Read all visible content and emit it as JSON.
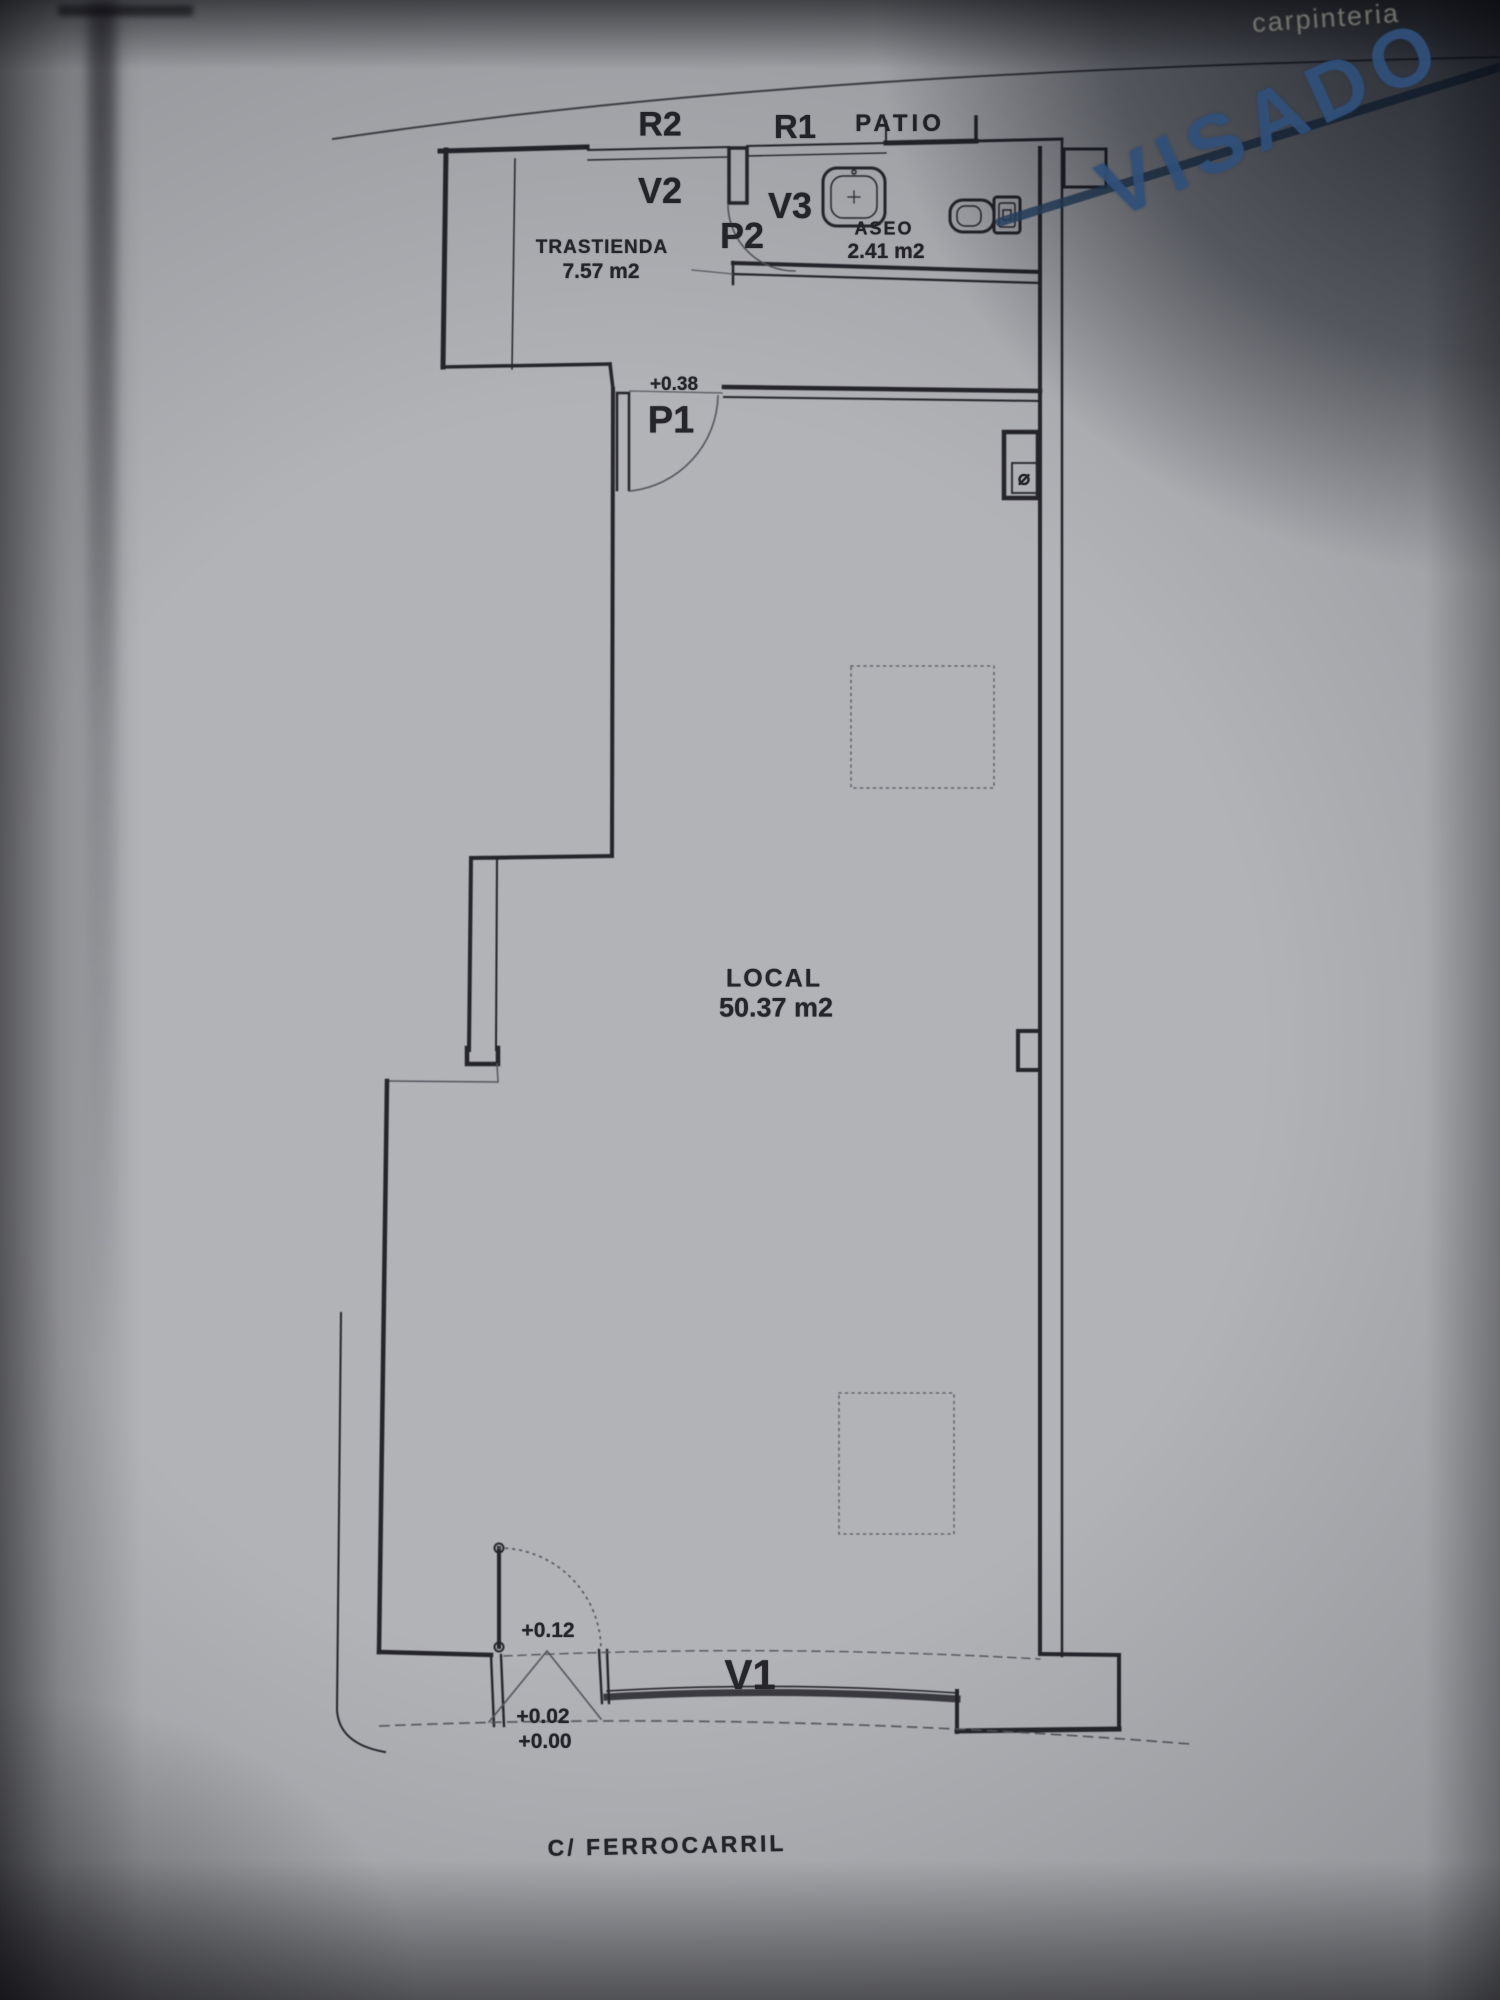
{
  "colors": {
    "paper": "#b2b3b7",
    "ink": "#25252b",
    "faint": "#54555c",
    "stamp": "#30507a",
    "note": "#8a8981"
  },
  "labels": {
    "r2": "R2",
    "r1": "R1",
    "patio": "PATIO",
    "v2": "V2",
    "v3": "V3",
    "p2": "P2",
    "trastienda": "TRASTIENDA",
    "trastienda_area": "7.57 m2",
    "aseo": "ASEO",
    "aseo_area": "2.41 m2",
    "level_hall": "+0.38",
    "p1": "P1",
    "local": "LOCAL",
    "local_area": "50.37 m2",
    "level_entry": "+0.12",
    "level_threshold": "+0.02",
    "level_street": "+0.00",
    "v1": "V1",
    "street": "C/ FERROCARRIL",
    "stamp": "VISADO",
    "corner_note": "carpinteria",
    "pipe_symbol": "⌀"
  }
}
